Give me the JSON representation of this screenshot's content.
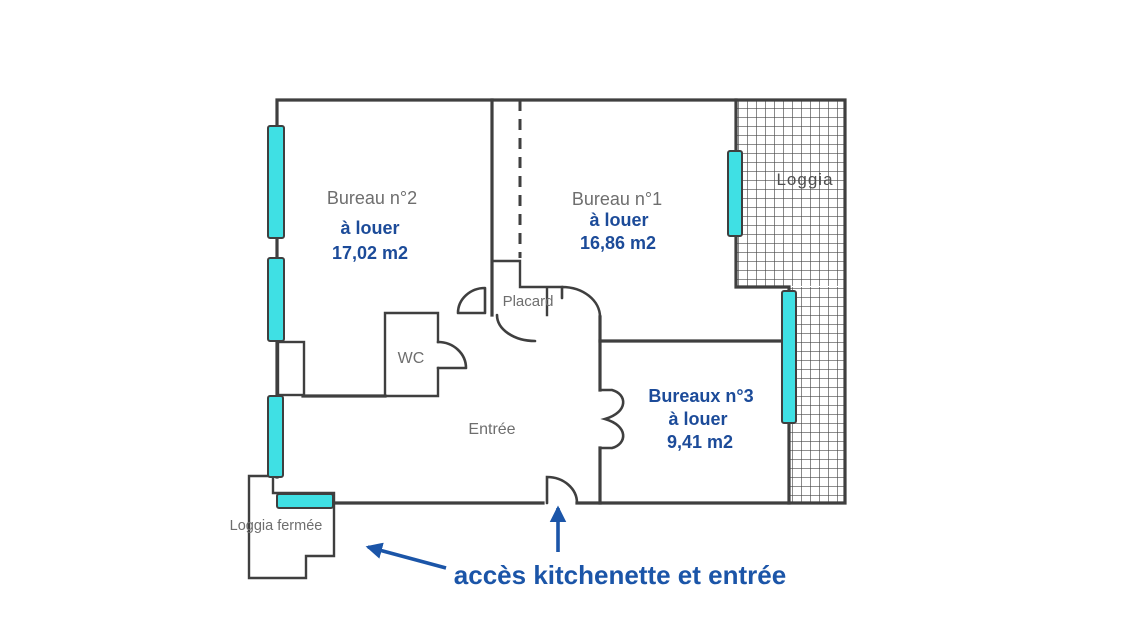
{
  "colors": {
    "background": "#ffffff",
    "wall": "#3f3f3f",
    "window_fill": "#3fe0e4",
    "label_gray": "#6e6e6e",
    "label_blue": "#1c4b99",
    "annotation_blue": "#1b55a8"
  },
  "rooms": [
    {
      "name": "Bureau n°2",
      "status": "à louer",
      "area": "17,02 m2"
    },
    {
      "name": "Bureau n°1",
      "status": "à louer",
      "area": "16,86 m2"
    },
    {
      "name": "Bureaux n°3",
      "status": "à louer",
      "area": "9,41 m2"
    }
  ],
  "areas": {
    "loggia": "Loggia",
    "loggia_fermee": "Loggia fermée",
    "placard": "Placard",
    "wc": "WC",
    "entree": "Entrée"
  },
  "annotation": {
    "label": "accès kitchenette et entrée"
  }
}
